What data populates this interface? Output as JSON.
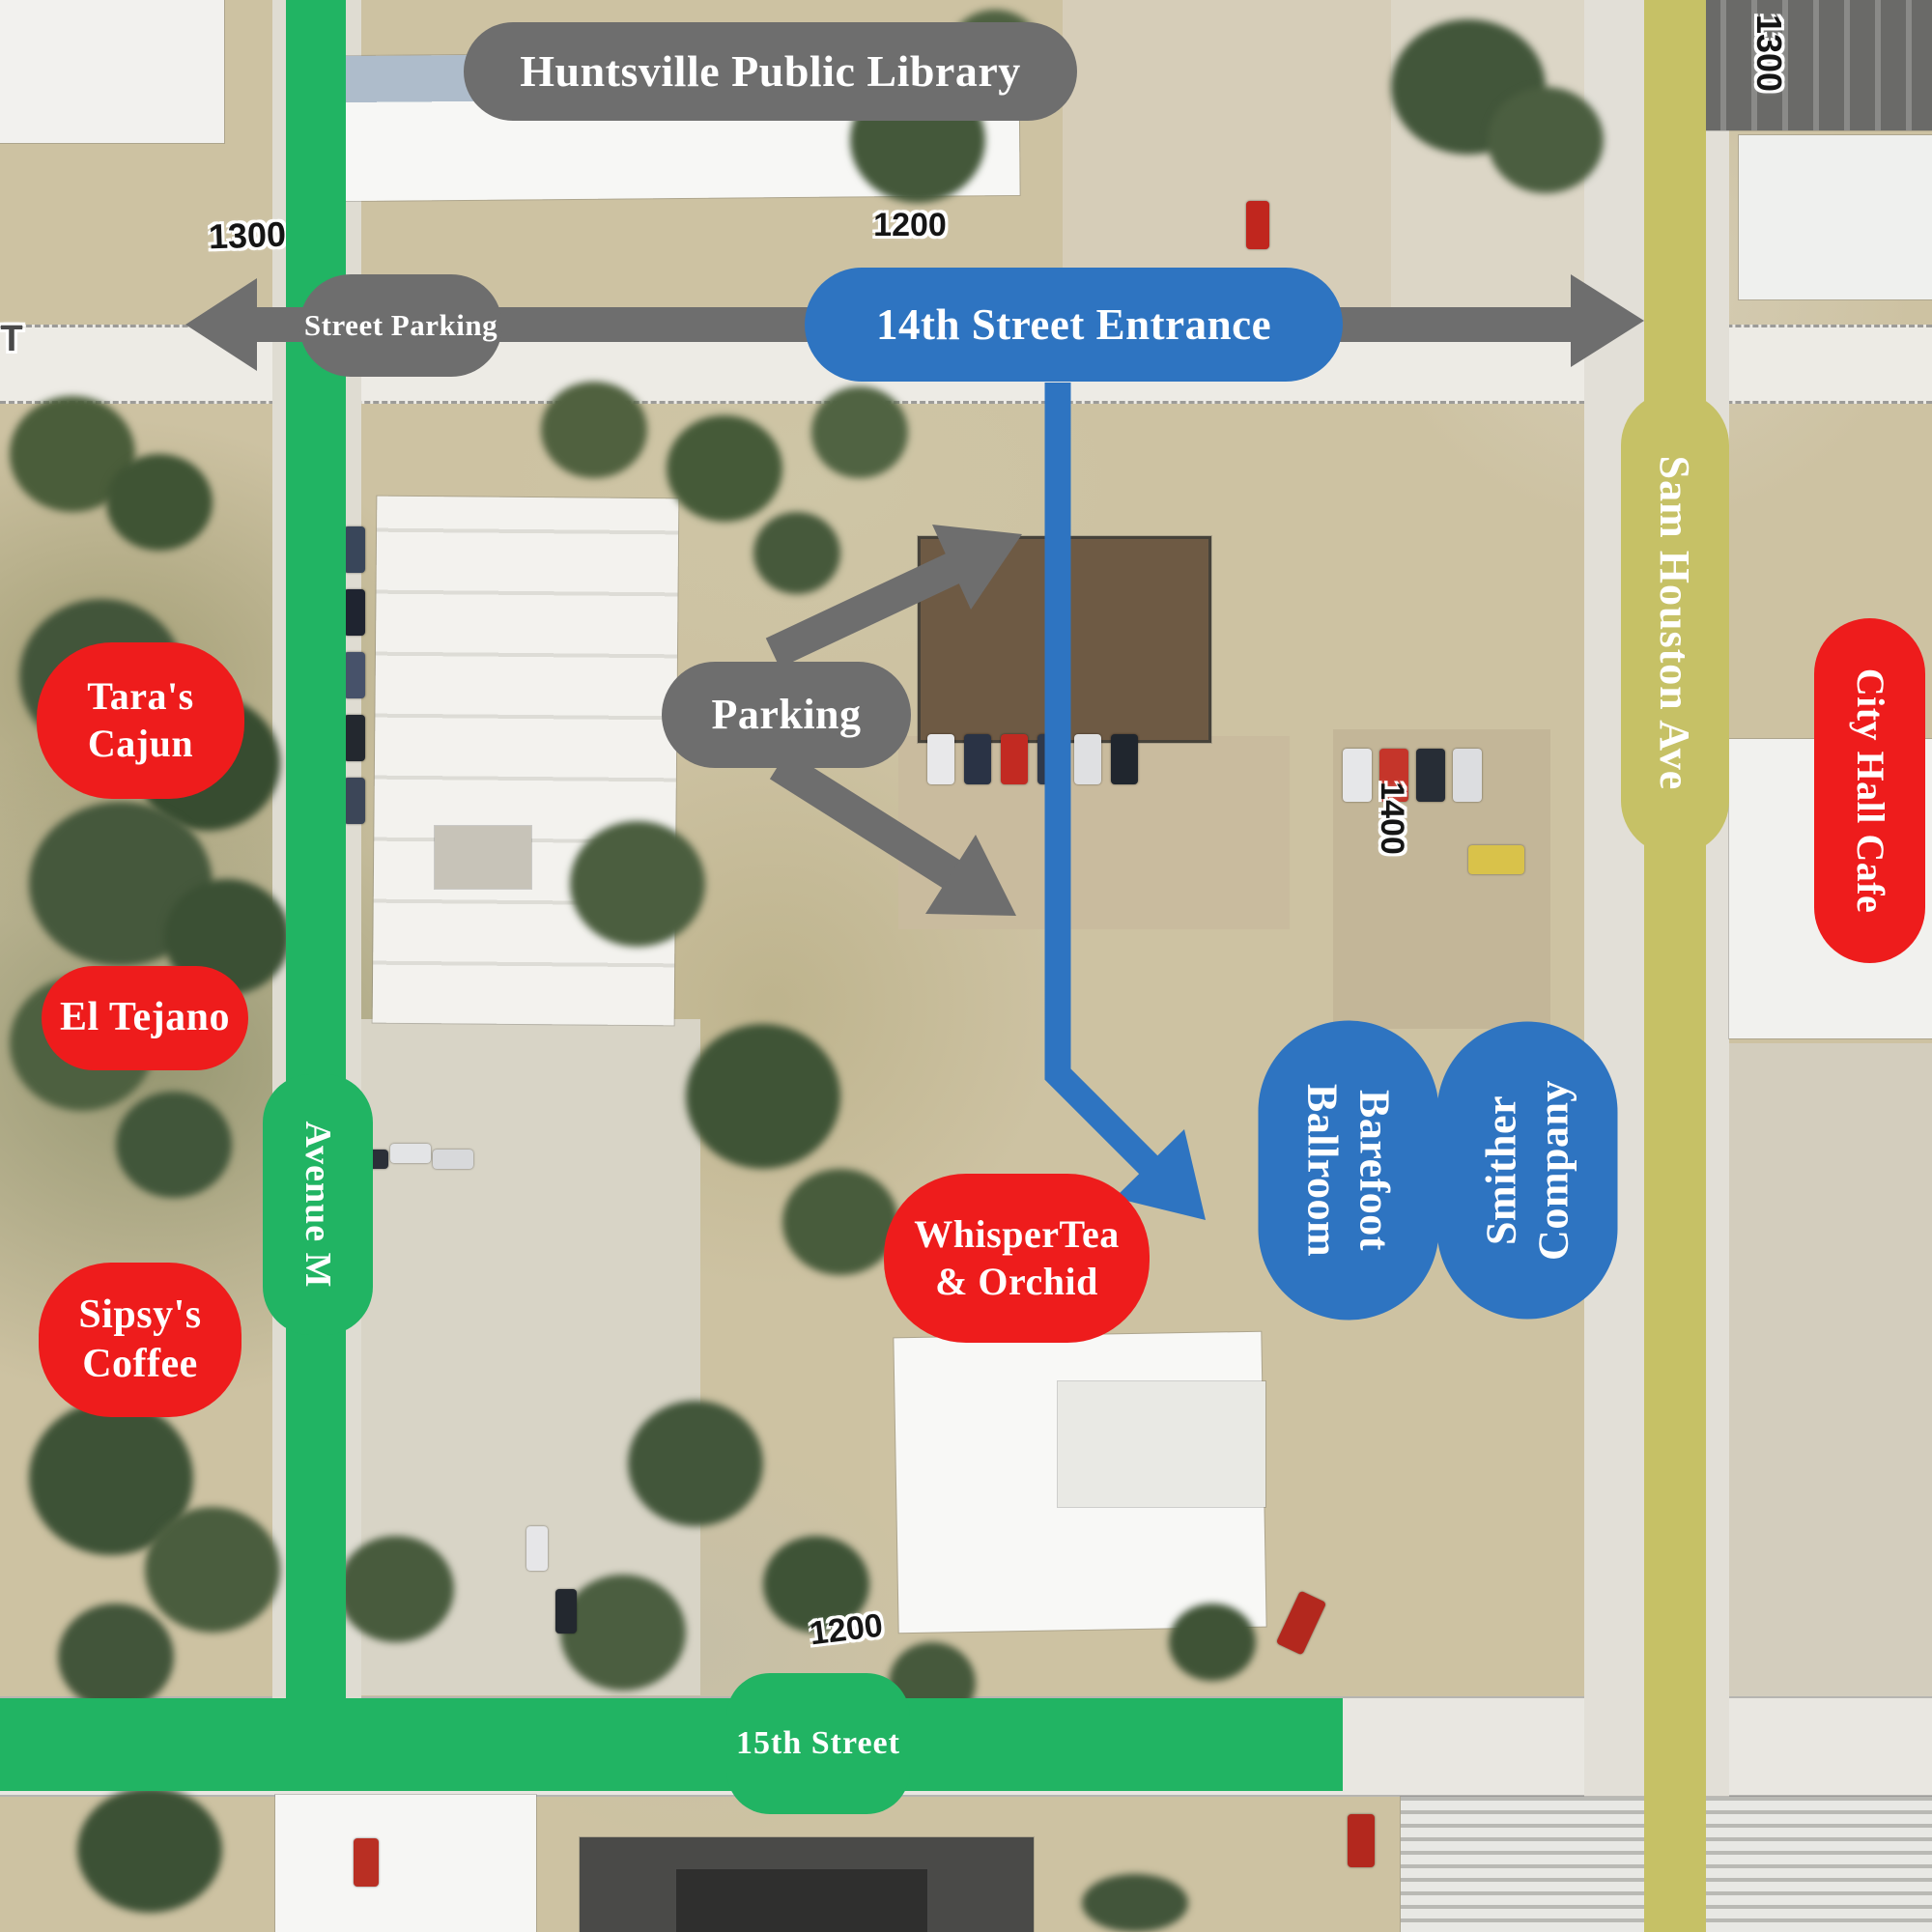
{
  "overlays": {
    "library": "Huntsville Public Library",
    "street_parking": "Street Parking",
    "entrance_14th": "14th Street Entrance",
    "parking": "Parking"
  },
  "venues": {
    "whispertea": {
      "line1": "WhisperTea",
      "line2": "& Orchid"
    },
    "barefoot": {
      "line1": "Barefoot",
      "line2": "Ballroom"
    },
    "smither": {
      "line1": "Smither",
      "line2": "Company"
    },
    "city_hall_cafe": "City Hall Cafe",
    "taras": {
      "line1": "Tara's",
      "line2": "Cajun"
    },
    "el_tejano": "El Tejano",
    "sipsys": {
      "line1": "Sipsy's",
      "line2": "Coffee"
    }
  },
  "roads": {
    "avenue_m": "Avenue M",
    "sam_houston": "Sam Houston Ave",
    "fifteenth_street": "15th Street"
  },
  "block_numbers": {
    "top_left_1300": "1300",
    "top_right_1300": "1300",
    "top_1200": "1200",
    "bottom_1200": "1200",
    "left_1400": "1400",
    "right_1400": "1400",
    "edge_partial": "T"
  },
  "colors": {
    "restaurant_red": "#ee1c1c",
    "venue_blue": "#2e74c1",
    "overlay_gray": "#6e6e6e",
    "road_green": "#21b463",
    "road_olive": "#c6c166"
  }
}
